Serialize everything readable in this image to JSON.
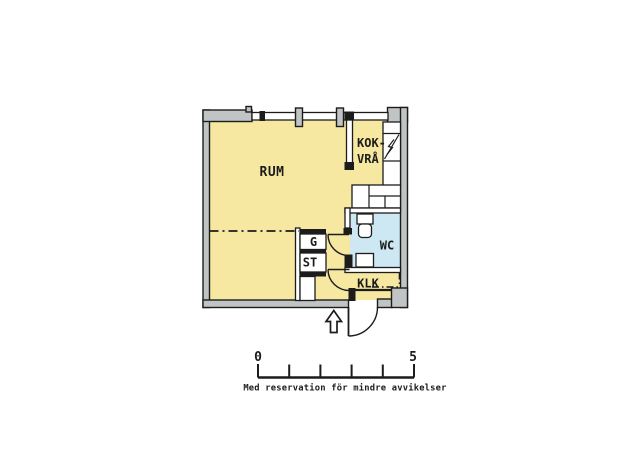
{
  "plan": {
    "labels": {
      "main_room": "RUM",
      "kitchenette_line1": "KOK-",
      "kitchenette_line2": "VRÅ",
      "wc": "WC",
      "closet": "KLK",
      "wardrobe": "G",
      "cleaning_closet": "ST"
    },
    "colors": {
      "floor": "#f6e7a1",
      "wet_room_floor": "#cde8f2",
      "wall_fill": "#c0c4c4",
      "line": "#1c1c1c"
    }
  },
  "scale_bar": {
    "start_label": "0",
    "end_label": "5"
  },
  "footer_note": "Med reservation för mindre avvikelser"
}
